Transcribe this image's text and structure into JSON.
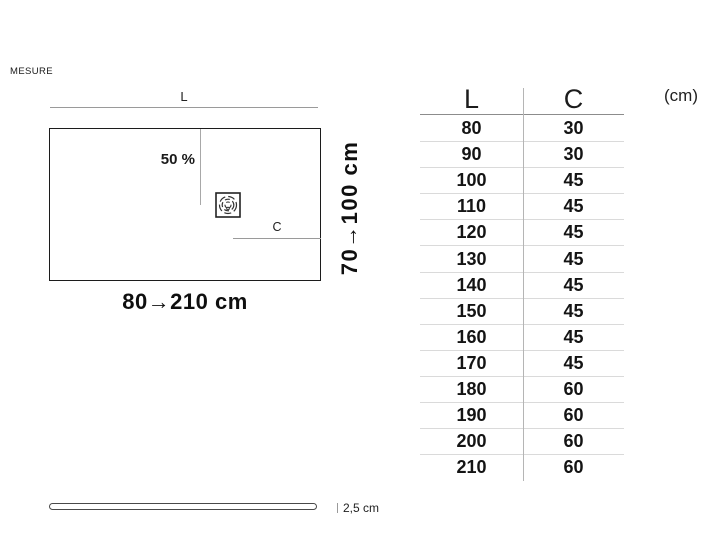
{
  "header": {
    "title": "MESURE"
  },
  "diagram": {
    "length_label": "L",
    "slope_label": "50 %",
    "channel_label": "C",
    "length_range": "80→210 cm",
    "width_range": "70→100 cm"
  },
  "thickness": {
    "label": "2,5 cm"
  },
  "size_table": {
    "col_l": "L",
    "col_c": "C",
    "unit_label": "(cm)",
    "rows": [
      {
        "l": "80",
        "c": "30"
      },
      {
        "l": "90",
        "c": "30"
      },
      {
        "l": "100",
        "c": "45"
      },
      {
        "l": "110",
        "c": "45"
      },
      {
        "l": "120",
        "c": "45"
      },
      {
        "l": "130",
        "c": "45"
      },
      {
        "l": "140",
        "c": "45"
      },
      {
        "l": "150",
        "c": "45"
      },
      {
        "l": "160",
        "c": "45"
      },
      {
        "l": "170",
        "c": "45"
      },
      {
        "l": "180",
        "c": "60"
      },
      {
        "l": "190",
        "c": "60"
      },
      {
        "l": "200",
        "c": "60"
      },
      {
        "l": "210",
        "c": "60"
      }
    ]
  },
  "colors": {
    "ink": "#111111",
    "dimension_line": "#9a9a9a",
    "header_rule": "#8c8c8c",
    "row_separator": "#dadada",
    "column_divider": "#b5b5b5"
  }
}
